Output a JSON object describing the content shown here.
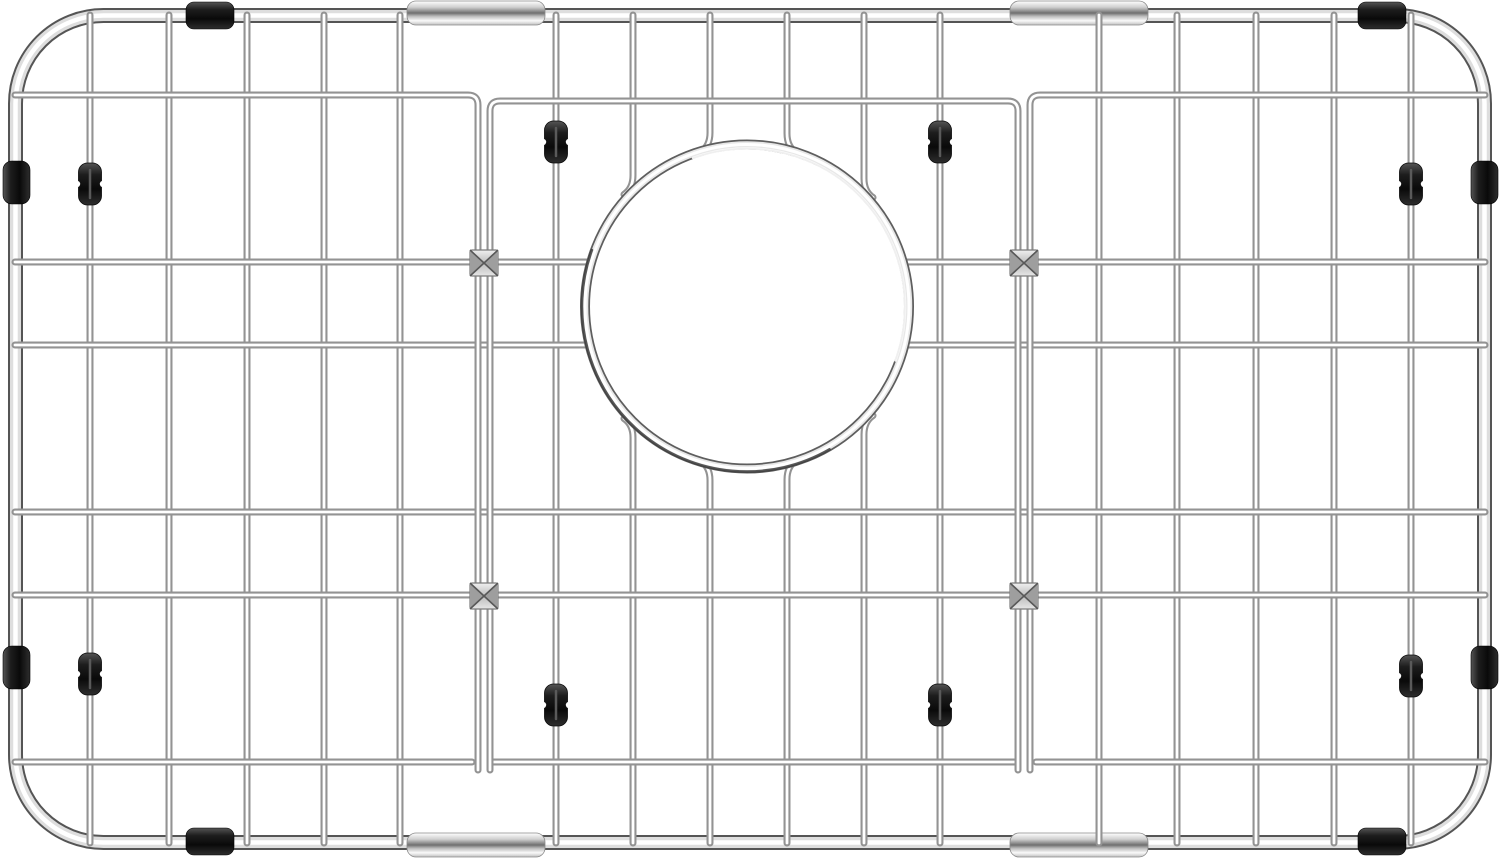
{
  "scene": {
    "type": "product-photo",
    "subject": "stainless-steel-sink-bottom-grid-with-drain-opening",
    "background": "#ffffff",
    "width": 1500,
    "height": 858
  },
  "colors": {
    "wire_edge": "#939393",
    "wire_core": "#ffffff",
    "frame_edge": "#555555",
    "frame_body": "#dedede",
    "frame_core": "#ffffff",
    "ring_edge": "#5e5e5e",
    "ring_body": "#e8e8e8",
    "ring_core": "#ffffff",
    "ring_shadow": "#3c3c3c",
    "ring_highlight": "#ffffff",
    "rubber_dark": "#0a0a0a",
    "rubber_mid": "#1d1d1d",
    "rubber_light": "#555555",
    "sleeve_light": "#fafafa",
    "sleeve_mid": "#6f6f6f",
    "sleeve_body": "#cfcfcf",
    "connector_face": "#d2d2d2",
    "connector_side": "#9e9e9e",
    "connector_line": "#585858",
    "clip_slit": "#5a5a5a"
  },
  "frame": {
    "x": 15.5,
    "y": 15.5,
    "w": 1469,
    "h": 827,
    "rx": 88,
    "strokes": [
      [
        15,
        "frame_edge"
      ],
      [
        11,
        "frame_body"
      ],
      [
        4.5,
        "frame_core"
      ]
    ]
  },
  "grid": {
    "wire_w": 7,
    "core_w": 2.8,
    "x_left": 15,
    "x_right": 1485,
    "v_top": 15,
    "v_bottom": 843,
    "verticals": [
      90,
      169,
      247,
      324,
      400,
      556,
      940,
      1099,
      1177,
      1256,
      1334,
      1411
    ],
    "interrupted_verticals": [
      633,
      710,
      787,
      864
    ],
    "rows_full": [
      512,
      595
    ],
    "rows_split_by_ring": [
      262,
      345
    ],
    "row_bottom": {
      "y": 762,
      "segments": [
        [
          15,
          472
        ],
        [
          492,
          1016
        ],
        [
          1036,
          1485
        ]
      ]
    },
    "row_top": {
      "y_outer": 95,
      "y_mid": 101,
      "left_bend": 478,
      "mid_left": 490,
      "mid_right": 1018,
      "right_bend": 1030,
      "pair_bottom": 770
    }
  },
  "ring": {
    "cx": 747,
    "cy": 306.5,
    "r": 162,
    "strokes": [
      [
        10,
        "ring_edge"
      ],
      [
        6.5,
        "ring_body"
      ],
      [
        3,
        "ring_core"
      ]
    ],
    "shadow_arc": "M829.5,449.4 A165,165 0 0 1 591.9,250.1",
    "highlight_arc": "M693,158 A158,158 0 0 1 895.5,360.5"
  },
  "sleeves": [
    [
      407,
      1,
      138,
      24
    ],
    [
      1010,
      1,
      138,
      24
    ],
    [
      407,
      833,
      138,
      24
    ],
    [
      1010,
      833,
      138,
      24
    ]
  ],
  "bumpers": {
    "top_bottom": [
      [
        186,
        2
      ],
      [
        1358,
        2
      ],
      [
        186,
        828
      ],
      [
        1358,
        828
      ]
    ],
    "tb_size": [
      48,
      27
    ],
    "sides": [
      [
        3,
        161
      ],
      [
        1471,
        161
      ],
      [
        3,
        646
      ],
      [
        1471,
        646
      ]
    ],
    "side_size": [
      27,
      43
    ]
  },
  "clips": {
    "size": [
      23,
      42
    ],
    "centers": [
      [
        90,
        184
      ],
      [
        1411,
        184
      ],
      [
        90,
        674
      ],
      [
        1411,
        676
      ],
      [
        556,
        142
      ],
      [
        940,
        142
      ],
      [
        556,
        705
      ],
      [
        940,
        705
      ]
    ]
  },
  "connectors": {
    "size": [
      28,
      26
    ],
    "centers": [
      [
        484,
        263
      ],
      [
        1024,
        263
      ],
      [
        484,
        596
      ],
      [
        1024,
        596
      ]
    ]
  }
}
